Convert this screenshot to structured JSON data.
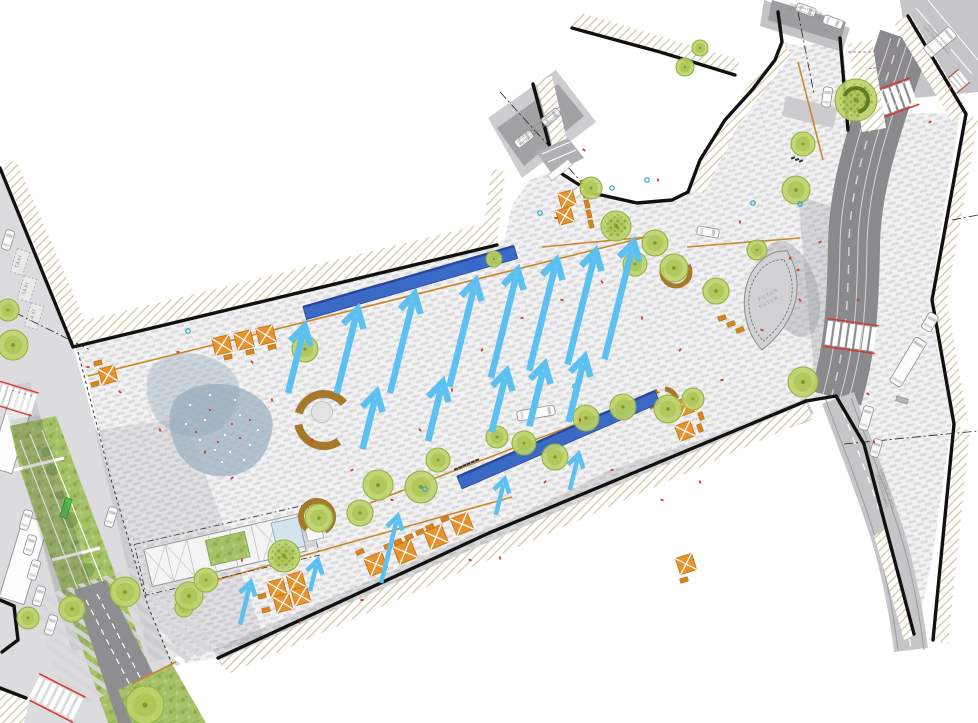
{
  "labels": {
    "taxi": "TAXI",
    "futur_line1": "FUTUR",
    "futur_line2": "FUTUR",
    "street_top_left_l1": "RUE PIERRE TIMMERMANS",
    "street_top_left_l2": "PIETER TIMMERMANSSTRAAT",
    "street_top_center_l1": "RUE LEON THEODOR",
    "street_top_center_l2": "LEON THEODORSTRAAT",
    "street_top_right_l1": "RUE LEON THEODOR",
    "street_top_right_l2": "LEON THEODORSTRAAT",
    "street_bottom_right_l1": "CHAUSSEE DE JETTE",
    "street_bottom_right_l2": "JETSESTEENWEG"
  },
  "colors": {
    "pav_bg": "#f2f2f3",
    "pav_dash": "#dcdcdf",
    "pavd_bg": "#d7d7d9",
    "pavd_dash": "#c6c6c9",
    "hatch": "#ccc79d",
    "road_dark": "#8a8a8c",
    "road_mid": "#a2a2a4",
    "road_light": "#c6c6c8",
    "corridor": "#dcdcde",
    "sidewalk": "#cdcdcf",
    "black": "#111111",
    "bench": "#3b69c6",
    "bench_edge": "#28479c",
    "arrow": "#5cc0f1",
    "table": "#e8922e",
    "table_dark": "#c87711",
    "chair": "#d8831d",
    "tree": "#bdd369",
    "tree_edge": "#94b140",
    "tree_inner": "#adc657",
    "tree_dot": "#7d9a33",
    "grass": "#a6c168",
    "pond": "#a3b4c4",
    "arc_brown": "#a5782a",
    "orange_line": "#c8882c",
    "red": "#d23b2f",
    "teal": "#2aa3c8",
    "label_gray": "#8a8a8a",
    "magenta": "#bb6cc4"
  },
  "geometry": {
    "plaza": "75,347 497,245 505,238 512,205 530,180 556,170 592,193 637,203 672,200 688,192 700,160 725,120 752,90 775,60 782,42 800,46 843,40 848,100 870,112 960,114 944,210 930,300 940,360 952,420 932,560 916,636 900,640 886,530 860,448 834,400 806,401 489,533 218,658 186,664 148,608 110,478 88,380",
    "corridor": "0,168 73,347 110,478 150,610 196,723 0,723",
    "median": "10,426 56,416 162,700 150,723 108,723 20,470",
    "branch_road": "74,590 106,580 178,723 118,723",
    "verge": "118,690 172,664 206,723 132,723",
    "zstripes": "30,600 170,555 215,650 70,710",
    "dark_zones": [
      "213,650 488,528 806,398 814,414 494,546 222,666",
      "470,540 610,470 700,440 790,408 806,398 812,420 700,460 480,560",
      "798,196 832,206 846,392 816,394"
    ],
    "shadows": [
      "0,388 30,382 96,600 60,612",
      "10,420 40,415 108,640 72,652",
      "95,430 185,418 265,640 150,662"
    ],
    "hatch_bands": [
      "2,166 75,345 92,337 16,160",
      "73,345 497,243 492,222 66,325",
      "482,238 492,168 505,172 497,243",
      "536,82 558,168 572,162 552,76",
      "572,26 735,73 740,60 578,12",
      "690,190 722,120 736,128 704,194",
      "722,120 782,44 792,54 736,128",
      "910,14 968,112 952,122 894,24",
      "966,114 932,300 946,304 978,120",
      "934,300 956,424 968,420 946,296",
      "956,426 933,640 948,644 970,430",
      "886,528 916,634 904,640 874,536",
      "220,660 806,403 812,418 228,674",
      "0,690 30,698 24,723 0,723",
      "848,44 872,40 886,128 862,132"
    ],
    "borders": [
      "0,168 73,347 497,245",
      "533,84 556,170 592,193 637,203 672,200 688,192",
      "778,12 782,42 775,60 752,90 725,120 700,160 688,192",
      "572,28 660,52 735,75",
      "218,658 489,533 806,401",
      "806,401 836,396 864,444 886,528 914,634",
      "908,16 966,114 932,300 954,424 933,640",
      "840,38 848,130",
      "0,600 14,606 18,640 2,652",
      "0,688 26,698"
    ],
    "pt_sidewalk": "488,118 556,70 596,122 522,178",
    "pt_road": "497,128 558,84 584,116 524,166",
    "top_sidewalk": "764,0 850,28 842,52 760,26",
    "top_road": "772,0 846,22 840,42 768,20",
    "apron": "786,96 838,108 833,128 782,116",
    "tr_road": "900,0 978,0 978,92 915,98",
    "corner_building": "536,152 568,138 584,158 552,174",
    "road1_path": "M 905,38 C 878,120 855,180 854,245 C 853,310 850,350 836,398",
    "chaussee_path": "M 838,398 C 852,436 872,486 886,530 C 898,568 906,610 911,650",
    "pond_path": "M 176,398 C 190,384 220,380 240,388 C 262,396 276,412 272,432 C 268,452 258,468 238,474 C 218,480 196,474 184,460 C 170,446 164,414 176,398 Z",
    "leaf_path": "M 787,251 C 804,278 802,318 762,350 C 744,332 738,296 752,272 C 762,256 775,250 787,251 Z",
    "magenta_path": "M 848,52 L 886,52 L 889,66 L 866,69",
    "dotted_boundary": "78,352 110,476 148,606 172,664"
  },
  "trees": [
    [
      8,
      310,
      11,
      0
    ],
    [
      13,
      345,
      15,
      0
    ],
    [
      28,
      618,
      11,
      0
    ],
    [
      72,
      609,
      13,
      0
    ],
    [
      125,
      592,
      15,
      0
    ],
    [
      184,
      608,
      9,
      0
    ],
    [
      145,
      705,
      19,
      0
    ],
    [
      189,
      596,
      14,
      0
    ],
    [
      206,
      580,
      12,
      0
    ],
    [
      284,
      556,
      16,
      1
    ],
    [
      305,
      349,
      13,
      0
    ],
    [
      378,
      485,
      15,
      0
    ],
    [
      421,
      487,
      16,
      0
    ],
    [
      360,
      513,
      13,
      0
    ],
    [
      319,
      518,
      14,
      0
    ],
    [
      438,
      460,
      12,
      0
    ],
    [
      497,
      437,
      11,
      0
    ],
    [
      524,
      443,
      12,
      0
    ],
    [
      555,
      457,
      13,
      0
    ],
    [
      586,
      418,
      13,
      0
    ],
    [
      623,
      407,
      13,
      0
    ],
    [
      668,
      409,
      14,
      0
    ],
    [
      693,
      399,
      11,
      0
    ],
    [
      803,
      382,
      15,
      0
    ],
    [
      591,
      188,
      11,
      0
    ],
    [
      616,
      226,
      15,
      1
    ],
    [
      655,
      243,
      13,
      0
    ],
    [
      635,
      264,
      12,
      0
    ],
    [
      674,
      268,
      14,
      0
    ],
    [
      716,
      291,
      13,
      0
    ],
    [
      757,
      250,
      10,
      0
    ],
    [
      803,
      144,
      12,
      0
    ],
    [
      796,
      190,
      14,
      0
    ],
    [
      856,
      100,
      21,
      1
    ],
    [
      685,
      67,
      9,
      0
    ],
    [
      700,
      48,
      8,
      0
    ],
    [
      494,
      259,
      8,
      0
    ]
  ],
  "arrows": {
    "angle_deg": 14,
    "large": [
      [
        305,
        325,
        70
      ],
      [
        358,
        308,
        88
      ],
      [
        415,
        293,
        103
      ],
      [
        476,
        280,
        110
      ],
      [
        518,
        269,
        112
      ],
      [
        557,
        259,
        115
      ],
      [
        596,
        250,
        118
      ],
      [
        634,
        241,
        122
      ],
      [
        377,
        391,
        60
      ],
      [
        443,
        381,
        62
      ],
      [
        507,
        370,
        64
      ],
      [
        545,
        363,
        65
      ],
      [
        585,
        356,
        68
      ]
    ],
    "small": [
      [
        251,
        581,
        45
      ],
      [
        318,
        559,
        33
      ],
      [
        398,
        515,
        70
      ],
      [
        505,
        478,
        38
      ],
      [
        579,
        453,
        38
      ]
    ]
  },
  "benches": [
    {
      "points": "303,307 514,246 517.6,258.5 306.6,319.5",
      "edge": [
        303,
        307,
        514,
        246
      ]
    },
    {
      "points": "457,477 655,391 660.2,402.9 462.2,488.9",
      "edge": [
        457,
        477,
        655,
        391
      ]
    }
  ],
  "tables": [
    [
      222,
      345,
      17,
      -13
    ],
    [
      244,
      340,
      17,
      -13
    ],
    [
      266,
      335,
      17,
      -13
    ],
    [
      108,
      375,
      16,
      -15
    ],
    [
      567,
      199,
      15,
      -15
    ],
    [
      565,
      216,
      15,
      -15
    ],
    [
      686,
      406,
      16,
      -20
    ],
    [
      685,
      431,
      16,
      -20
    ],
    [
      376,
      564,
      19,
      -22
    ],
    [
      405,
      552,
      19,
      -22
    ],
    [
      436,
      537,
      19,
      -22
    ],
    [
      462,
      524,
      18,
      -22
    ],
    [
      277,
      588,
      16,
      -15
    ],
    [
      296,
      581,
      16,
      -15
    ],
    [
      283,
      603,
      16,
      -15
    ],
    [
      301,
      596,
      16,
      -15
    ],
    [
      686,
      564,
      17,
      -18
    ]
  ],
  "chairs": [
    [
      228,
      357,
      -13
    ],
    [
      250,
      352,
      -13
    ],
    [
      272,
      347,
      -13
    ],
    [
      98,
      363,
      -15
    ],
    [
      95,
      384,
      -15
    ],
    [
      585,
      194,
      75
    ],
    [
      587,
      204,
      75
    ],
    [
      589,
      214,
      75
    ],
    [
      591,
      224,
      75
    ],
    [
      583,
      184,
      75
    ],
    [
      701,
      416,
      70
    ],
    [
      700,
      428,
      70
    ],
    [
      388,
      546,
      -22
    ],
    [
      398,
      542,
      -22
    ],
    [
      409,
      537,
      -22
    ],
    [
      420,
      532,
      -22
    ],
    [
      430,
      527,
      -22
    ],
    [
      445,
      519,
      -22
    ],
    [
      360,
      552,
      -22
    ],
    [
      262,
      596,
      -15
    ],
    [
      266,
      610,
      -15
    ],
    [
      684,
      580,
      -18
    ],
    [
      722,
      318,
      -20
    ],
    [
      731,
      324,
      -20
    ],
    [
      740,
      330,
      -20
    ]
  ],
  "arcs": [
    [
      324,
      420,
      26,
      55,
      170,
      8
    ],
    [
      324,
      420,
      26,
      195,
      320,
      8
    ],
    [
      317,
      517,
      16,
      130,
      420,
      6
    ],
    [
      676,
      272,
      14,
      -30,
      200,
      5
    ],
    [
      664,
      402,
      13,
      150,
      240,
      5
    ],
    [
      664,
      402,
      13,
      275,
      345,
      5
    ]
  ],
  "arc_inner_circle": [
    322,
    412,
    10.5
  ],
  "cars": [
    [
      8,
      240,
      17,
      20,
      9
    ],
    [
      26,
      520,
      17,
      20,
      9
    ],
    [
      30,
      545,
      17,
      20,
      9
    ],
    [
      34,
      570,
      17,
      20,
      9
    ],
    [
      39,
      596,
      17,
      20,
      9
    ],
    [
      51,
      625,
      17,
      20,
      9
    ],
    [
      111,
      517,
      17,
      20,
      9
    ],
    [
      524,
      139,
      52,
      20,
      9
    ],
    [
      551,
      117,
      52,
      20,
      9
    ],
    [
      806,
      10,
      110,
      20,
      9
    ],
    [
      833,
      22,
      110,
      20,
      9
    ],
    [
      708,
      232,
      100,
      22,
      9
    ],
    [
      827,
      97,
      8,
      20,
      9
    ],
    [
      866,
      418,
      16,
      24,
      10
    ],
    [
      876,
      448,
      16,
      18,
      9
    ]
  ],
  "bus": [
    940,
    42,
    50,
    34,
    13
  ],
  "truck_center": [
    536,
    413,
    80,
    38,
    10
  ],
  "artic_truck": {
    "cab": [
      930,
      322,
      30,
      18,
      11
    ],
    "trailer": [
      908,
      362,
      31,
      52,
      13
    ]
  },
  "taxi_bays": [
    [
      20,
      262
    ],
    [
      27,
      289
    ],
    [
      34,
      316
    ]
  ],
  "taxi_rot": 17,
  "crosswalks": [
    [
      890,
      100,
      -20,
      1
    ],
    [
      851,
      336,
      8,
      1
    ],
    [
      952,
      86,
      -40,
      0.62
    ],
    [
      56,
      698,
      27,
      1
    ],
    [
      14,
      398,
      17,
      0.85
    ]
  ],
  "orange_lines": [
    [
      88,
      376,
      650,
      236
    ],
    [
      370,
      503,
      660,
      392
    ],
    [
      213,
      581,
      512,
      497
    ],
    [
      542,
      247,
      658,
      236
    ],
    [
      687,
      247,
      800,
      238
    ],
    [
      798,
      62,
      823,
      160
    ],
    [
      132,
      684,
      176,
      662
    ]
  ],
  "dash_dot": [
    [
      500,
      92,
      585,
      186
    ],
    [
      0,
      305,
      90,
      350
    ],
    [
      844,
      444,
      978,
      431
    ],
    [
      798,
      12,
      814,
      94
    ],
    [
      952,
      220,
      978,
      215
    ]
  ],
  "red_dots": [
    [
      88,
      367
    ],
    [
      120,
      392
    ],
    [
      160,
      430
    ],
    [
      205,
      452
    ],
    [
      232,
      478
    ],
    [
      178,
      352
    ],
    [
      252,
      362
    ],
    [
      272,
      400
    ],
    [
      312,
      440
    ],
    [
      352,
      470
    ],
    [
      392,
      500
    ],
    [
      420,
      430
    ],
    [
      452,
      390
    ],
    [
      482,
      350
    ],
    [
      522,
      318
    ],
    [
      562,
      300
    ],
    [
      602,
      282
    ],
    [
      642,
      318
    ],
    [
      680,
      350
    ],
    [
      722,
      380
    ],
    [
      762,
      330
    ],
    [
      800,
      300
    ],
    [
      580,
      420
    ],
    [
      545,
      482
    ],
    [
      612,
      470
    ],
    [
      662,
      500
    ],
    [
      700,
      482
    ],
    [
      242,
      560
    ],
    [
      300,
      622
    ],
    [
      362,
      600
    ],
    [
      470,
      560
    ],
    [
      500,
      558
    ],
    [
      740,
      222
    ],
    [
      820,
      242
    ],
    [
      858,
      300
    ],
    [
      868,
      394
    ],
    [
      874,
      442
    ],
    [
      950,
      88
    ],
    [
      930,
      122
    ],
    [
      556,
      218
    ],
    [
      584,
      150
    ],
    [
      658,
      180
    ],
    [
      790,
      258
    ],
    [
      798,
      270
    ]
  ],
  "teal_dots": [
    [
      188,
      331
    ],
    [
      425,
      489
    ],
    [
      575,
      386
    ],
    [
      612,
      188
    ],
    [
      647,
      180
    ],
    [
      753,
      203
    ],
    [
      540,
      213
    ],
    [
      800,
      204
    ]
  ],
  "pond_white_dots": [
    [
      190,
      405
    ],
    [
      205,
      420
    ],
    [
      225,
      435
    ],
    [
      240,
      415
    ],
    [
      215,
      450
    ],
    [
      250,
      445
    ],
    [
      200,
      440
    ],
    [
      235,
      400
    ],
    [
      258,
      430
    ],
    [
      186,
      424
    ],
    [
      222,
      462
    ],
    [
      244,
      460
    ],
    [
      210,
      395
    ],
    [
      230,
      452
    ]
  ],
  "pond_red_dots": [
    [
      210,
      410
    ],
    [
      232,
      424
    ],
    [
      196,
      432
    ],
    [
      250,
      420
    ],
    [
      218,
      442
    ],
    [
      240,
      438
    ]
  ],
  "median_blobs_dark": [
    [
      52,
      470,
      6
    ],
    [
      70,
      520,
      8
    ],
    [
      88,
      570,
      7
    ],
    [
      105,
      615,
      9
    ],
    [
      122,
      660,
      8
    ],
    [
      60,
      495,
      5
    ],
    [
      96,
      590,
      6
    ],
    [
      76,
      545,
      5
    ],
    [
      112,
      634,
      6
    ],
    [
      130,
      676,
      7
    ],
    [
      46,
      452,
      5
    ]
  ],
  "median_blobs_light": [
    [
      58,
      488,
      4
    ],
    [
      80,
      548,
      5
    ],
    [
      100,
      600,
      5
    ],
    [
      118,
      648,
      5
    ]
  ],
  "tram_lines": [
    [
      20,
      440,
      105,
      660
    ],
    [
      30,
      434,
      118,
      655
    ],
    [
      42,
      430,
      130,
      650
    ]
  ],
  "tram_cross": [
    [
      14,
      470,
      64,
      458
    ],
    [
      52,
      560,
      100,
      548
    ]
  ],
  "green_bench": [
    66,
    508,
    7,
    20,
    17
  ],
  "buildings_left": [
    [
      12,
      432,
      24,
      80,
      17
    ],
    [
      24,
      560,
      26,
      85,
      17
    ]
  ],
  "canopies": [
    [
      560,
      170,
      -38
    ],
    [
      580,
      190,
      -38
    ]
  ],
  "bus_shelter": [
    902,
    400,
    12,
    5,
    17
  ],
  "ticks": [
    {
      "x": 456,
      "y": 469,
      "n": 6,
      "dx": 4.2,
      "dy": -1.8,
      "rot": 70
    },
    {
      "x": 793,
      "y": 158,
      "n": 3,
      "dx": 4,
      "dy": 1.5,
      "rot": 70
    }
  ],
  "street_labels": [
    {
      "x": 538,
      "y": 126,
      "rot": -38,
      "l1key": "street_top_left_l1",
      "l2key": "street_top_left_l2",
      "s": 3.6
    },
    {
      "x": 806,
      "y": 10,
      "rot": 17,
      "l1key": "street_top_center_l1",
      "l2key": "street_top_center_l2",
      "s": 3.2
    },
    {
      "x": 939,
      "y": 38,
      "rot": 48,
      "l1key": "street_top_right_l1",
      "l2key": "street_top_right_l2",
      "s": 3.2
    },
    {
      "x": 886,
      "y": 490,
      "rot": 74,
      "l1key": "street_bottom_right_l1",
      "l2key": "street_bottom_right_l2",
      "s": 4
    }
  ],
  "futur_label": {
    "x": 769,
    "y": 296,
    "rot": -28,
    "s": 5
  },
  "kiosk": {
    "x": 226,
    "y": 550,
    "rot": -13
  },
  "branch_dashes": [
    [
      86,
      600,
      146,
      716
    ],
    [
      97,
      594,
      158,
      712
    ]
  ],
  "tr_lanes": [
    [
      916,
      8,
      972,
      74
    ],
    [
      928,
      0,
      978,
      60
    ]
  ]
}
